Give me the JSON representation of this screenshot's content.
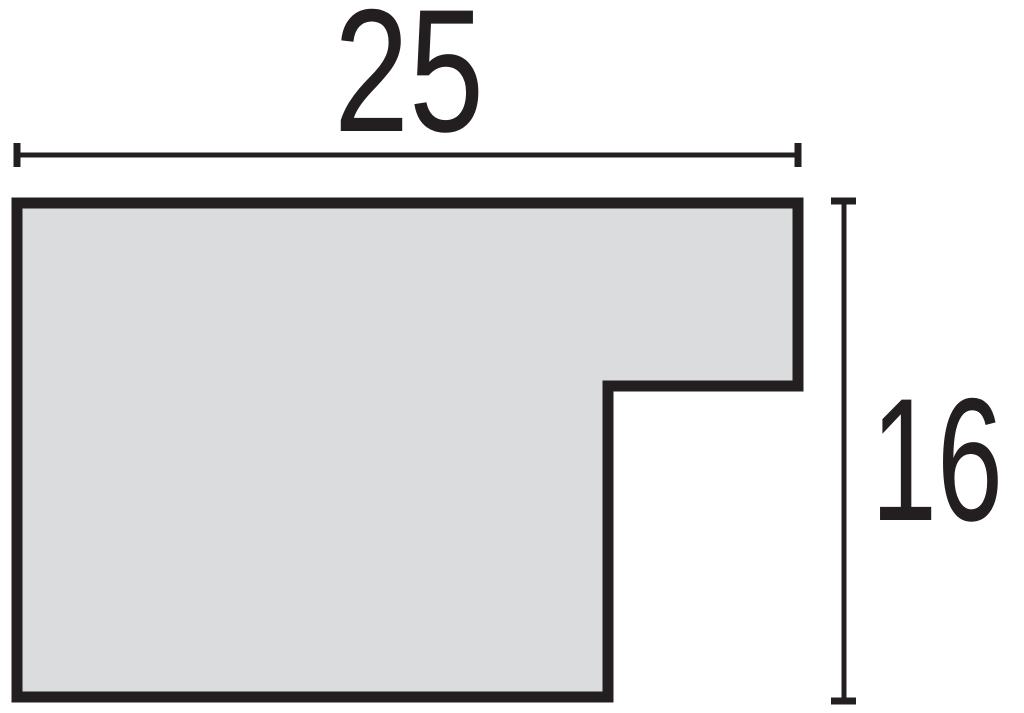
{
  "diagram": {
    "type": "moulding-profile-cross-section",
    "background_color": "#ffffff",
    "shape_fill_color": "#dbdcdd",
    "line_color": "#231f20",
    "width_dimension": {
      "label": "25"
    },
    "height_dimension": {
      "label": "16"
    }
  }
}
